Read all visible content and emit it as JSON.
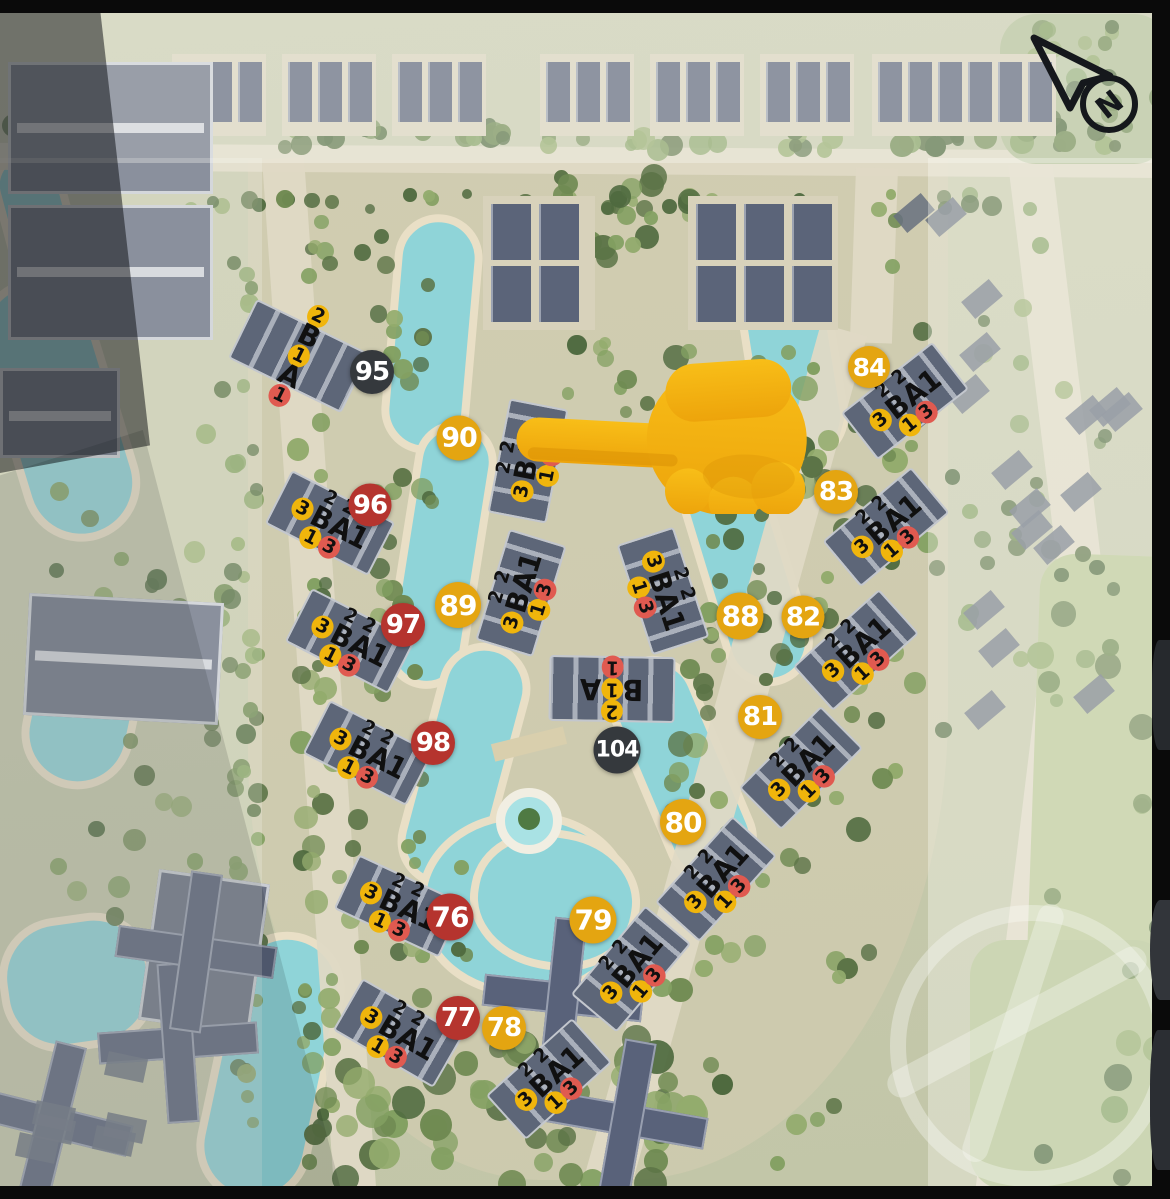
{
  "compass": {
    "label": "N"
  },
  "pointer_icon": "backhand-index-pointing-left",
  "palette": {
    "badge_yellow": "#E4A511",
    "badge_red": "#B5342E",
    "badge_dark": "#35393D",
    "token_yellow": "#F0B50C",
    "token_red": "#E05A50",
    "water": "#8FD4D8",
    "sand": "#E9DFC6"
  },
  "badges": [
    {
      "label": "95",
      "color": "dark",
      "x": 372,
      "y": 372,
      "d": 44
    },
    {
      "label": "96",
      "color": "red",
      "x": 370,
      "y": 505,
      "d": 43
    },
    {
      "label": "97",
      "color": "red",
      "x": 403,
      "y": 625,
      "d": 44
    },
    {
      "label": "98",
      "color": "red",
      "x": 433,
      "y": 743,
      "d": 44
    },
    {
      "label": "76",
      "color": "red",
      "x": 450,
      "y": 917,
      "d": 47
    },
    {
      "label": "77",
      "color": "red",
      "x": 458,
      "y": 1018,
      "d": 44
    },
    {
      "label": "78",
      "color": "yellow",
      "x": 504,
      "y": 1028,
      "d": 44
    },
    {
      "label": "79",
      "color": "yellow",
      "x": 593,
      "y": 920,
      "d": 47
    },
    {
      "label": "80",
      "color": "yellow",
      "x": 683,
      "y": 822,
      "d": 46
    },
    {
      "label": "81",
      "color": "yellow",
      "x": 760,
      "y": 717,
      "d": 44
    },
    {
      "label": "82",
      "color": "yellow",
      "x": 803,
      "y": 617,
      "d": 43
    },
    {
      "label": "83",
      "color": "yellow",
      "x": 836,
      "y": 492,
      "d": 44
    },
    {
      "label": "84",
      "color": "yellow",
      "x": 869,
      "y": 367,
      "d": 42
    },
    {
      "label": "87",
      "color": "yellow",
      "x": 771,
      "y": 457,
      "d": 42
    },
    {
      "label": "88",
      "color": "yellow",
      "x": 740,
      "y": 616,
      "d": 47
    },
    {
      "label": "89",
      "color": "yellow",
      "x": 458,
      "y": 605,
      "d": 46
    },
    {
      "label": "90",
      "color": "yellow",
      "x": 459,
      "y": 438,
      "d": 45
    },
    {
      "label": "104",
      "color": "dark",
      "x": 617,
      "y": 750,
      "d": 47
    }
  ],
  "label_templates": {
    "BA1": [
      [
        {
          "t": "2"
        },
        {
          "t": "2"
        }
      ],
      [
        {
          "t": "3",
          "c": "yellow"
        },
        {
          "t": "B",
          "big": true
        },
        {
          "t": "A1",
          "big": true
        }
      ],
      [
        {
          "t": "1",
          "c": "yellow"
        },
        {
          "t": "3",
          "c": "red"
        }
      ]
    ],
    "B1A": [
      [
        {
          "t": "2",
          "c": "yellow"
        }
      ],
      [
        {
          "t": "B",
          "big": true
        },
        {
          "t": "1",
          "c": "yellow"
        },
        {
          "t": "A",
          "big": true
        }
      ],
      [
        {
          "t": "1",
          "c": "red"
        }
      ]
    ]
  },
  "buildings": [
    {
      "x": 299,
      "y": 356,
      "rot": 26,
      "type": "B1A",
      "layout": "col"
    },
    {
      "x": 330,
      "y": 523,
      "rot": 27,
      "type": "BA1"
    },
    {
      "x": 350,
      "y": 641,
      "rot": 27,
      "type": "BA1"
    },
    {
      "x": 368,
      "y": 753,
      "rot": 27,
      "type": "BA1"
    },
    {
      "x": 399,
      "y": 906,
      "rot": 25,
      "type": "BA1"
    },
    {
      "x": 398,
      "y": 1033,
      "rot": 30,
      "type": "BA1"
    },
    {
      "x": 528,
      "y": 461,
      "rot": -79,
      "type": "BA1"
    },
    {
      "x": 521,
      "y": 593,
      "rot": -73,
      "type": "BA1"
    },
    {
      "x": 663,
      "y": 591,
      "rot": 72,
      "type": "BA1"
    },
    {
      "x": 612,
      "y": 689,
      "rot": 181,
      "type": "B1A",
      "layout": "row"
    },
    {
      "x": 905,
      "y": 401,
      "rot": -38,
      "type": "BA1"
    },
    {
      "x": 886,
      "y": 527,
      "rot": -40,
      "type": "BA1"
    },
    {
      "x": 856,
      "y": 650,
      "rot": -42,
      "type": "BA1"
    },
    {
      "x": 801,
      "y": 768,
      "rot": -45,
      "type": "BA1"
    },
    {
      "x": 716,
      "y": 879,
      "rot": -48,
      "type": "BA1"
    },
    {
      "x": 631,
      "y": 969,
      "rot": -50,
      "type": "BA1"
    },
    {
      "x": 549,
      "y": 1079,
      "rot": -42,
      "type": "BA1"
    }
  ]
}
